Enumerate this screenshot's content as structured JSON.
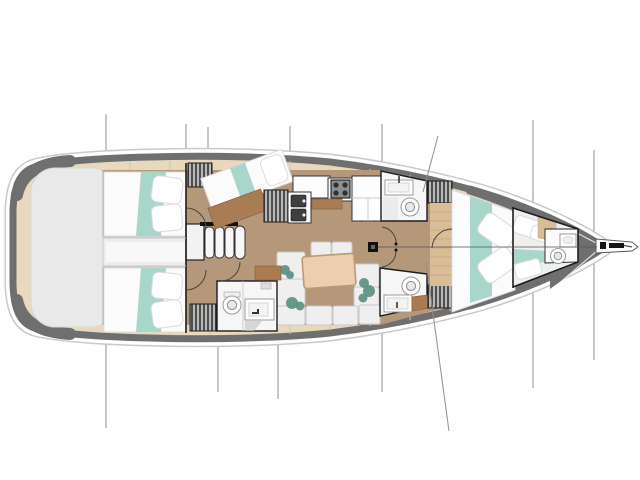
{
  "diagram": {
    "type": "sailing-yacht-floor-plan",
    "view": "top-down",
    "bow_direction": "right",
    "stern_direction": "left"
  },
  "colors": {
    "hull_band": "#6f6f6f",
    "hull_outline": "#c9c9c9",
    "deck_wood": "#e8d9bc",
    "plank_line": "#d5c5a5",
    "floor_wood": "#b5977a",
    "floor_wood_dark": "#a97c54",
    "bedding_white": "#fbfbfb",
    "bedding_edge": "#dcdcdc",
    "teal_bedding": "#a9d6cb",
    "plant_teal": "#5a9183",
    "locker_dark": "#4e4e4e",
    "locker_stripe": "#d2d2d2",
    "wall": "#1c1c1c",
    "fixture_bg": "#f6f6f6",
    "porcelain": "#ffffff",
    "stove_panel": "#8f8f8f",
    "stove_dark": "#2f2f2f",
    "sink_dark": "#3f3f3f",
    "table_wood": "#eccfae",
    "table_edge": "#bd9a73",
    "sofa": "#efefef",
    "sofa_edge": "#c9c9c9",
    "transom": "#e9e9e9",
    "transom_edge": "#d7d7d7",
    "rigging": "#8f8f8f",
    "mast": "#111111",
    "floor_plank": "#d9bd97",
    "floor_plank_line": "#c2a77e",
    "engine_strip": "#ededed"
  },
  "features": {
    "stern_swim_platform": true,
    "cabins": [
      "aft-cabin-port",
      "aft-cabin-starboard",
      "pullman-berth-port",
      "owner-cabin-forward",
      "bow-crew-cabin"
    ],
    "heads": [
      "aft-head",
      "forward-head-port",
      "forward-head-starboard",
      "bow-head"
    ],
    "toilets": 4,
    "bathroom_sinks": 4,
    "companionway_steps": 4,
    "galley": {
      "stove_burners": 4,
      "sinks": 2,
      "refrigerator": true
    },
    "salon": {
      "dining_table": true,
      "sofa_sections": 8,
      "plants": 3
    },
    "hanging_lockers": 5,
    "mast": true,
    "forestay_line": true,
    "bowsprit_with_anchor_roller": true
  }
}
